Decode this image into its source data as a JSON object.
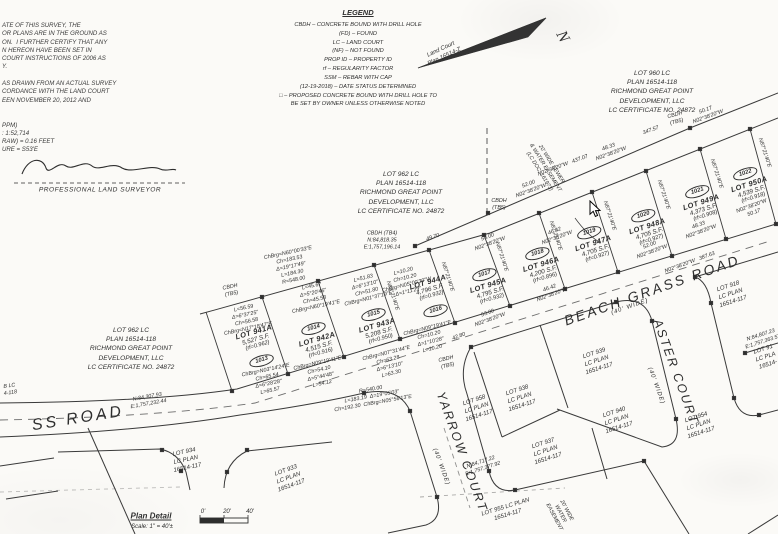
{
  "notes": {
    "lines": [
      "ATE OF THIS SURVEY, THE",
      "OR PLANS ARE IN THE GROUND AS",
      "ON.  I FURTHER CERTIFY THAT ANY",
      "N HEREON HAVE BEEN SET IN",
      "COURT INSTRUCTIONS OF 2006 AS",
      "Y.",
      "",
      "AS DRAWN FROM AN ACTUAL SURVEY",
      "CORDANCE WITH THE LAND COURT",
      "EEN NOVEMBER 20, 2012 AND",
      "",
      "",
      "PPM)",
      ": 1:52,714",
      "RAW) = 0.16 FEET",
      "URE = S53'E"
    ],
    "surveyor_title": "PROFESSIONAL LAND SURVEYOR"
  },
  "legend": {
    "title": "LEGEND",
    "entries": [
      "CBDH – CONCRETE BOUND WITH DRILL HOLE",
      "(FD) – FOUND",
      "LC – LAND COURT",
      "(NF) – NOT FOUND",
      "PROP ID – PROPERTY ID",
      "rf – REGULARITY FACTOR",
      "SSM – REBAR WITH CAP",
      "(12-19-2018) – DATE STATUS DETERMINED",
      "□ – PROPOSED CONCRETE BOUND WITH DRILL HOLE TO",
      "BE SET BY OWNER UNLESS OTHERWISE NOTED"
    ]
  },
  "north_arrow": {
    "n": "N",
    "ref": "Land Court\nPlan 16514-Z"
  },
  "abutters": [
    {
      "x": 652,
      "y": 92,
      "r": 0,
      "lines": [
        "LOT 960 LC",
        "PLAN 16514-118",
        "RICHMOND GREAT POINT",
        "DEVELOPMENT, LLC",
        "LC CERTIFICATE NO. 24872"
      ]
    },
    {
      "x": 401,
      "y": 193,
      "r": 0,
      "lines": [
        "LOT 962 LC",
        "PLAN 16514-118",
        "RICHMOND GREAT POINT",
        "DEVELOPMENT, LLC",
        "LC CERTIFICATE NO. 24872"
      ]
    },
    {
      "x": 131,
      "y": 349,
      "r": 0,
      "lines": [
        "LOT 962 LC",
        "PLAN 16514-118",
        "RICHMOND GREAT POINT",
        "DEVELOPMENT, LLC",
        "LC CERTIFICATE NO. 24872"
      ]
    }
  ],
  "parcels": [
    {
      "lot": "LOT 941A",
      "area": "5,527 S.F.",
      "rf": "(rf=0.962)",
      "prop_id": "1013",
      "x": 258,
      "y": 347,
      "r": -16,
      "oval": "below"
    },
    {
      "lot": "LOT 942A",
      "area": "4,515 S.F.",
      "rf": "(rf=0.916)",
      "prop_id": "1014",
      "x": 316,
      "y": 336,
      "r": -16,
      "oval": "above"
    },
    {
      "lot": "LOT 943A",
      "area": "5,208 S.F.",
      "rf": "(rf=0.950)",
      "prop_id": "1015",
      "x": 376,
      "y": 322,
      "r": -16,
      "oval": "above"
    },
    {
      "lot": "LOT 944A",
      "area": "4,796 S.F.",
      "rf": "(rf=0.932)",
      "prop_id": "1016",
      "x": 432,
      "y": 297,
      "r": -16,
      "oval": "below"
    },
    {
      "lot": "LOT 945A",
      "area": "4,795 S.F.",
      "rf": "(rf=0.932)",
      "prop_id": "1017",
      "x": 487,
      "y": 282,
      "r": -17,
      "oval": "above"
    },
    {
      "lot": "LOT 946A",
      "area": "4,200 S.F.",
      "rf": "(rf=0.896)",
      "prop_id": "1018",
      "x": 540,
      "y": 261,
      "r": -17,
      "oval": "above"
    },
    {
      "lot": "LOT 947A",
      "area": "4,705 S.F.",
      "rf": "(rf=0.927)",
      "prop_id": "1019",
      "x": 592,
      "y": 240,
      "r": -18,
      "oval": "above"
    },
    {
      "lot": "LOT 948A",
      "area": "4,705 S.F.",
      "rf": "(rf=0.927)",
      "prop_id": "1020",
      "x": 646,
      "y": 223,
      "r": -18,
      "oval": "above"
    },
    {
      "lot": "LOT 949A",
      "area": "4,373 S.F.",
      "rf": "(rf=0.908)",
      "prop_id": "1021",
      "x": 700,
      "y": 199,
      "r": -18,
      "oval": "above"
    },
    {
      "lot": "LOT 950A",
      "area": "4,539 S.F.",
      "rf": "(rf=0.918)",
      "prop_id": "1022",
      "x": 748,
      "y": 181,
      "r": -18,
      "oval": "above"
    }
  ],
  "south_lots": [
    {
      "x": 477,
      "y": 409,
      "r": -18,
      "lines": [
        "LOT 958",
        "LC PLAN",
        "16514-117"
      ]
    },
    {
      "x": 520,
      "y": 399,
      "r": -18,
      "lines": [
        "LOT 938",
        "LC PLAN",
        "16514-117"
      ]
    },
    {
      "x": 597,
      "y": 362,
      "r": -18,
      "lines": [
        "LOT 939",
        "LC PLAN",
        "16514-117"
      ]
    },
    {
      "x": 546,
      "y": 452,
      "r": -18,
      "lines": [
        "LOT 937",
        "LC PLAN",
        "16514-117"
      ]
    },
    {
      "x": 617,
      "y": 421,
      "r": -18,
      "lines": [
        "LOT 940",
        "LC PLAN",
        "16514-117"
      ]
    },
    {
      "x": 699,
      "y": 426,
      "r": -18,
      "lines": [
        "LOT 954",
        "LC PLAN",
        "16514-117"
      ]
    },
    {
      "x": 731,
      "y": 295,
      "r": -18,
      "lines": [
        "LOT 918",
        "LC PLAN",
        "16514-117"
      ]
    },
    {
      "x": 766,
      "y": 358,
      "r": -18,
      "lines": [
        "LOT 91",
        "LC PLA",
        "16514-"
      ]
    },
    {
      "x": 186,
      "y": 461,
      "r": -12,
      "lines": [
        "LOT 934",
        "LC PLAN",
        "16514-117"
      ]
    },
    {
      "x": 289,
      "y": 479,
      "r": -20,
      "lines": [
        "LOT 933",
        "LC PLAN",
        "16514-117"
      ]
    },
    {
      "x": 507,
      "y": 512,
      "r": -17,
      "lines": [
        "LOT 955 LC PLAN",
        "16514-117"
      ]
    }
  ],
  "roads": {
    "beach_grass": {
      "name": "BEACH GRASS ROAD",
      "width": "(40' WIDE)"
    },
    "beach_grass_west": {
      "name": "SS ROAD"
    },
    "yarrow": {
      "name": "YARROW COURT",
      "width": "(40' WIDE)"
    },
    "aster": {
      "name": "ASTER COURT",
      "width": "(40' WIDE)"
    }
  },
  "plan_detail": {
    "title": "Plan Detail",
    "scale": "Scale: 1\" = 40'±",
    "bar_labels": [
      "0'",
      "20'",
      "40'"
    ]
  },
  "annotations": [
    {
      "t": "N02°38'20\"W   437.07",
      "x": 563,
      "y": 166,
      "r": -20
    },
    {
      "t": "347.57",
      "x": 651,
      "y": 131,
      "r": -20
    },
    {
      "t": "CBDH\n(TB5)",
      "x": 676,
      "y": 119,
      "r": -15
    },
    {
      "t": "CBDH\n(TB5)",
      "x": 499,
      "y": 205,
      "r": 0
    },
    {
      "t": "CBDH (TB4)\nN:84,818.35\nE:1,757,196.14",
      "x": 382,
      "y": 241,
      "r": 0
    },
    {
      "t": "52.00\nN02°38'20\"W",
      "x": 530,
      "y": 188,
      "r": -20
    },
    {
      "t": "48.33\nN02°38'20\"W",
      "x": 610,
      "y": 151,
      "r": -20
    },
    {
      "t": "50.17\nN02°38'20\"W",
      "x": 707,
      "y": 114,
      "r": -20
    },
    {
      "t": "46.42\nN02°38'20\"W",
      "x": 556,
      "y": 235,
      "r": -20
    },
    {
      "t": "49.70",
      "x": 433,
      "y": 238,
      "r": -18
    },
    {
      "t": "53.00\nN02°38'20\"W",
      "x": 489,
      "y": 241,
      "r": -20
    },
    {
      "t": "53.00\nN02°38'20\"W",
      "x": 489,
      "y": 317,
      "r": -20
    },
    {
      "t": "46.42\nN02°38'20\"W",
      "x": 551,
      "y": 292,
      "r": -20
    },
    {
      "t": "52.00\nN02°38'20\"W",
      "x": 651,
      "y": 249,
      "r": -20
    },
    {
      "t": "48.33\nN02°38'20\"W",
      "x": 700,
      "y": 229,
      "r": -20
    },
    {
      "t": "N02°38'20\"W\n50.17",
      "x": 753,
      "y": 210,
      "r": -20
    },
    {
      "t": "N02°38'20\"W   387.63",
      "x": 690,
      "y": 263,
      "r": -20
    },
    {
      "t": "42.80",
      "x": 459,
      "y": 337,
      "r": -20
    },
    {
      "t": "ChBrg=N60°00'33\"E\nCh=183.53\nΔ=19°17'49\"\nL=184.30\nR=548.00",
      "x": 291,
      "y": 267,
      "r": -12
    },
    {
      "t": "L=56.59\nΔ=6°37'25\"\nCh=56.58\nChBrg=N17°18'47\"E",
      "x": 246,
      "y": 319,
      "r": -12
    },
    {
      "t": "L=45.67\nΔ=5°20'46\"\nCh=45.58\nChBrg=N60°19'41\"E",
      "x": 314,
      "y": 297,
      "r": -12
    },
    {
      "t": "L=51.83\nΔ=6°13'10\"\nCh=51.80\nChBrg=N01°37'19\"E",
      "x": 366,
      "y": 289,
      "r": -14
    },
    {
      "t": "ChBrg=N07°31'44\"E\nCh=63.28\nΔ=6°13'10\"\nL=63.30",
      "x": 389,
      "y": 364,
      "r": -14
    },
    {
      "t": "ChBrg=N09°19'41\"E\nCh=10.20\nΔ=1°10'28\"\nL=10.20",
      "x": 430,
      "y": 339,
      "r": -14
    },
    {
      "t": "L=10.20\nCh=10.20\nChBrg=N05°00'30\"W\nΔ=1°11'29\"",
      "x": 406,
      "y": 282,
      "r": -14
    },
    {
      "t": "ChBrg=N03°14'24\"E\nCh=65.54\nΔ=6°28'28\"\nL=65.57",
      "x": 268,
      "y": 381,
      "r": -12
    },
    {
      "t": "ChBrg=N09°19'41\"E\nCh=54.10\nΔ=5°44'48\"\nL=54.12",
      "x": 320,
      "y": 374,
      "r": -13
    },
    {
      "t": "R=540.00\nL=183.19  Δ=19°05'03\"\nCh=192.30  ChBrg=N05°56'13\"E",
      "x": 372,
      "y": 397,
      "r": -10
    },
    {
      "t": "N:84,307.93\nE:1,757,232.44",
      "x": 148,
      "y": 401,
      "r": -10
    },
    {
      "t": "N:84,717.22\nE:1,757,377.92",
      "x": 482,
      "y": 466,
      "r": -18
    },
    {
      "t": "N:84,807.23\nE:1,757,363.57",
      "x": 762,
      "y": 339,
      "r": -18
    },
    {
      "t": "CBDH\n(TB5)",
      "x": 447,
      "y": 363,
      "r": -14
    },
    {
      "t": "CBDH\n(TB5)",
      "x": 231,
      "y": 291,
      "r": -12
    },
    {
      "t": "N87°21'40\"E",
      "x": 392,
      "y": 296,
      "r": 72
    },
    {
      "t": "N87°21'40\"E",
      "x": 447,
      "y": 277,
      "r": 72
    },
    {
      "t": "N87°21'40\"E",
      "x": 501,
      "y": 257,
      "r": 72
    },
    {
      "t": "N87°21'40\"E",
      "x": 555,
      "y": 236,
      "r": 72
    },
    {
      "t": "N87°21'40\"E",
      "x": 609,
      "y": 216,
      "r": 72
    },
    {
      "t": "N87°21'40\"E",
      "x": 663,
      "y": 195,
      "r": 72
    },
    {
      "t": "N87°21'40\"E",
      "x": 716,
      "y": 174,
      "r": 72
    },
    {
      "t": "N87°21'40\"E",
      "x": 764,
      "y": 153,
      "r": 72
    },
    {
      "t": "B LC\n4-118",
      "x": 10,
      "y": 390,
      "r": -8
    },
    {
      "t": "20' WIDE SEWER\n& WATER EASEMENT\n(LC DOC. 161973)",
      "x": 545,
      "y": 168,
      "r": 58
    },
    {
      "t": "20' WIDE\nWATER\nEASEMENT",
      "x": 560,
      "y": 514,
      "r": 62
    }
  ]
}
